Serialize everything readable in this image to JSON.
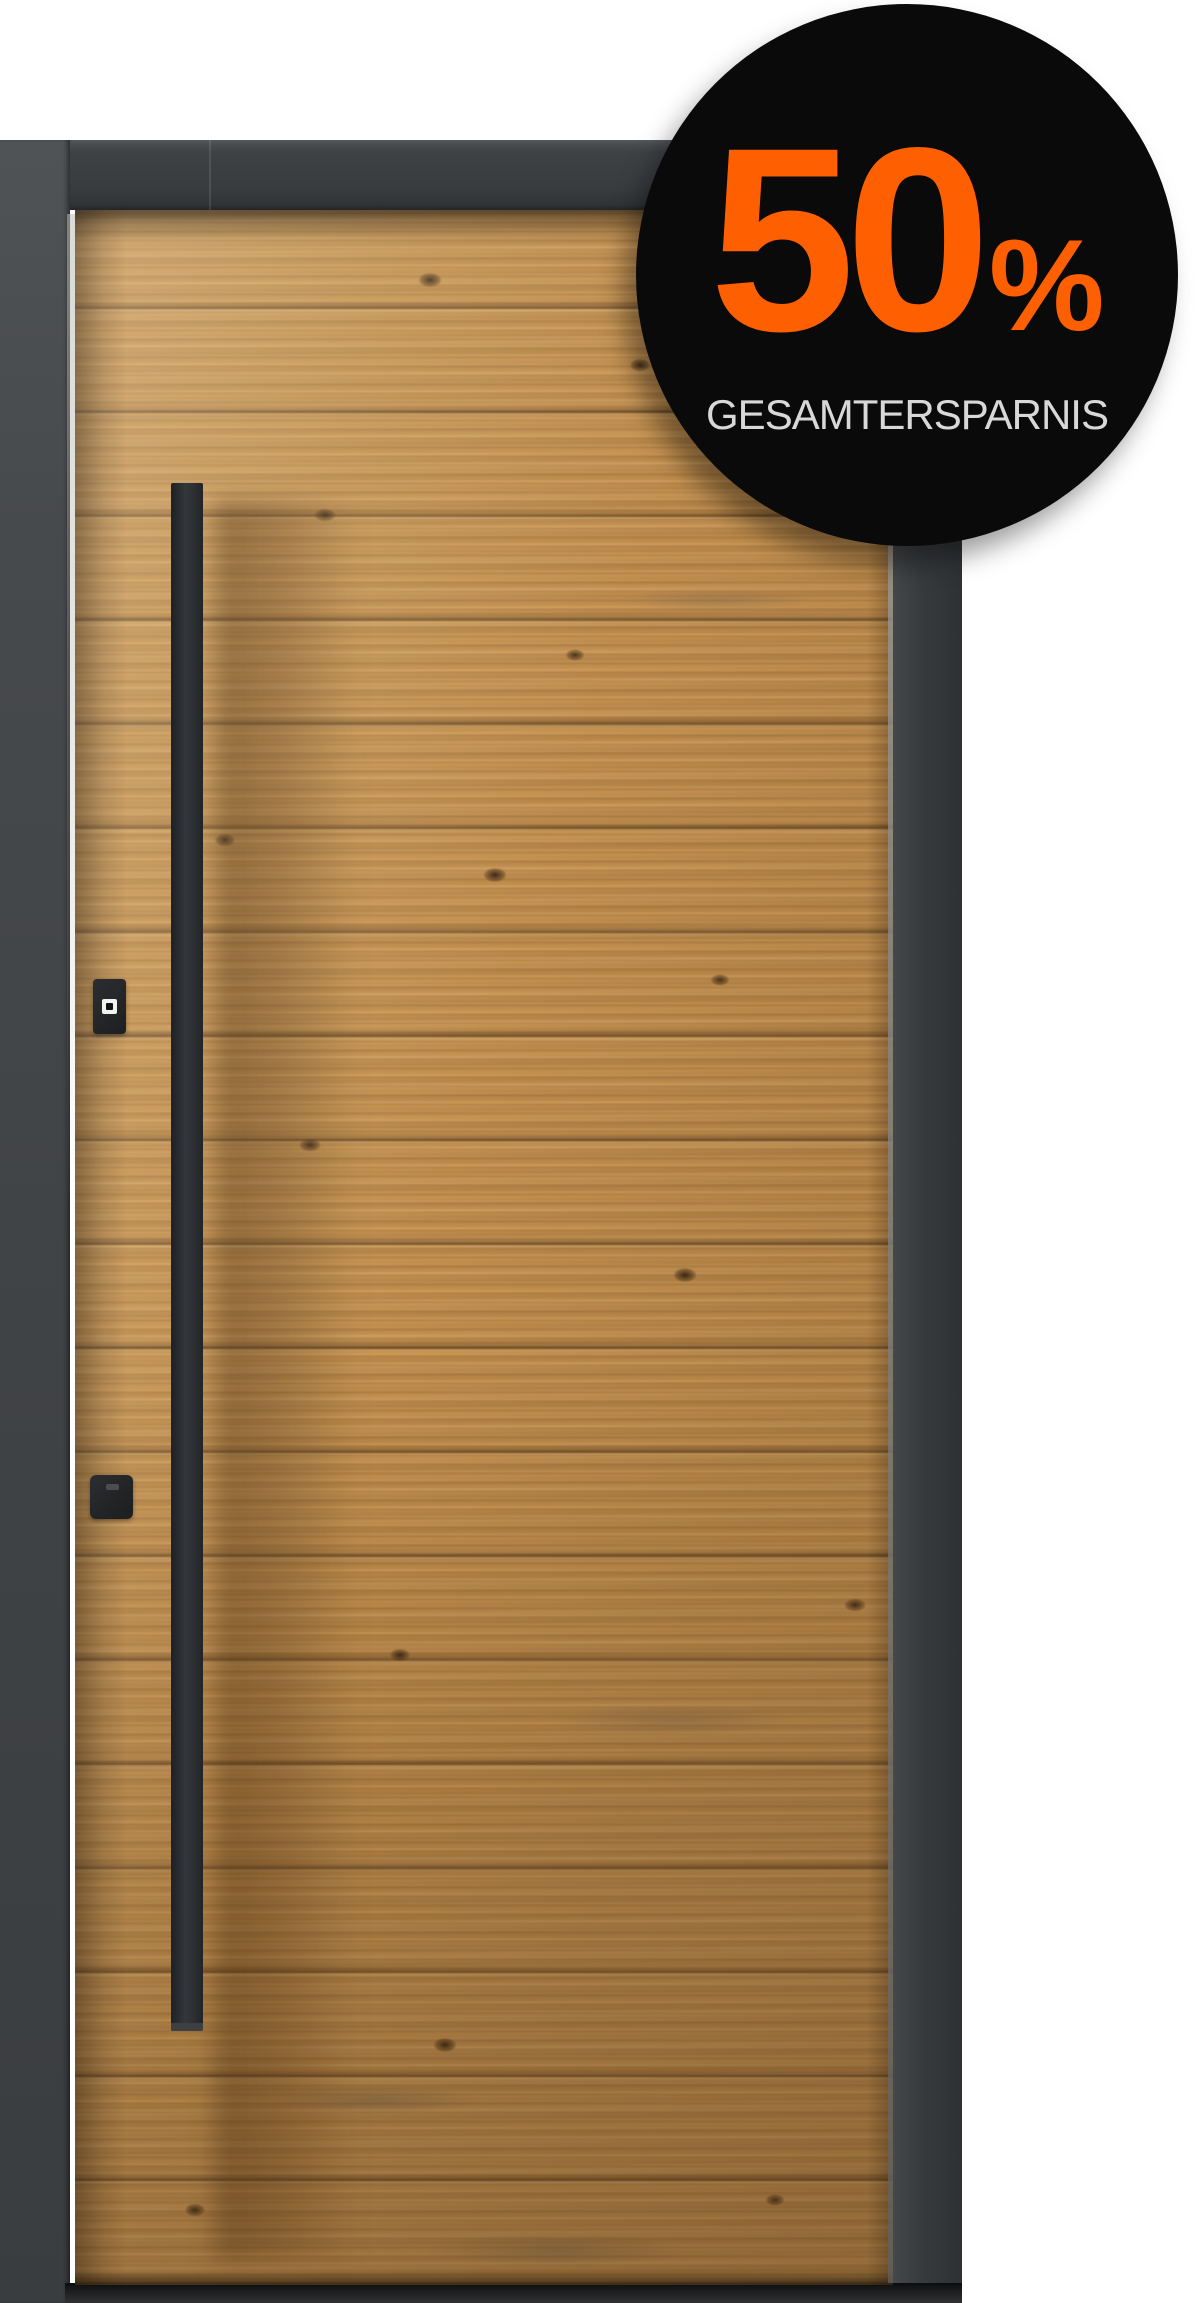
{
  "badge": {
    "value": "50",
    "percent_sign": "%",
    "caption": "GESAMTERSPARNIS"
  },
  "colors": {
    "badge-bg": "#0a0a0b",
    "accent-orange": "#fe5f00",
    "caption-gray": "#d8d8d8",
    "frame-anthracite": "#3b3e41",
    "wood-oak": "#c4914f",
    "handle-black": "#2c3033"
  },
  "parts": {
    "door_leaf": "rustic-spruce-wood-panel",
    "handle": "vertical-bar-pull-handle",
    "hardware": [
      "fingerprint-scanner",
      "lock-module"
    ]
  }
}
